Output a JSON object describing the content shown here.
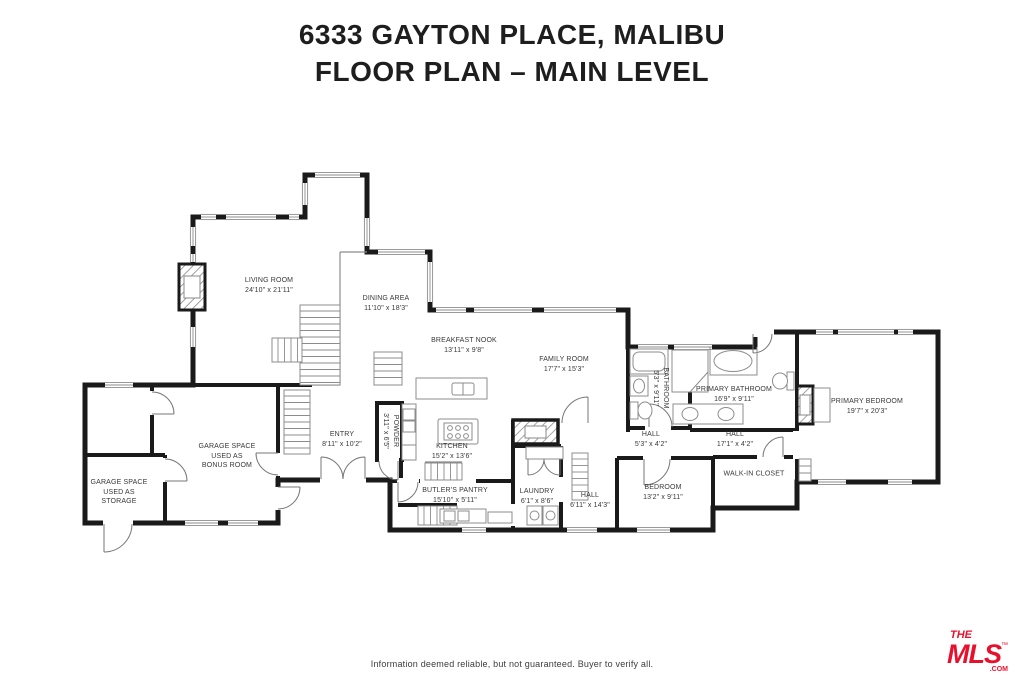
{
  "title": {
    "line1": "6333 GAYTON PLACE, MALIBU",
    "line2": "FLOOR PLAN – MAIN LEVEL"
  },
  "rooms": {
    "living_room": {
      "name": "LIVING ROOM",
      "dims": "24'10\" x 21'11\""
    },
    "dining_area": {
      "name": "DINING AREA",
      "dims": "11'10\" x 18'3\""
    },
    "breakfast_nook": {
      "name": "BREAKFAST NOOK",
      "dims": "13'11\" x 9'8\""
    },
    "family_room": {
      "name": "FAMILY ROOM",
      "dims": "17'7\" x 15'3\""
    },
    "kitchen": {
      "name": "KITCHEN",
      "dims": "15'2\" x 13'6\""
    },
    "entry": {
      "name": "ENTRY",
      "dims": "8'11\" x 10'2\""
    },
    "powder": {
      "name": "POWDER",
      "dims": "3'11\" x 6'5\""
    },
    "butlers_pantry": {
      "name": "BUTLER'S PANTRY",
      "dims": "15'10\" x 5'11\""
    },
    "laundry": {
      "name": "LAUNDRY",
      "dims": "6'1\" x 8'6\""
    },
    "hall": {
      "name": "HALL",
      "dims": "6'11\" x 14'3\""
    },
    "bedroom": {
      "name": "BEDROOM",
      "dims": "13'2\" x 9'11\""
    },
    "bathroom": {
      "name": "BATHROOM",
      "dims": "5'3\" x 9'11\""
    },
    "hall_small": {
      "name": "HALL",
      "dims": "5'3\" x 4'2\""
    },
    "primary_bathroom": {
      "name": "PRIMARY BATHROOM",
      "dims": "16'9\" x 9'11\""
    },
    "hall_primary": {
      "name": "HALL",
      "dims": "17'1\" x 4'2\""
    },
    "walk_in_closet": {
      "name": "WALK-IN CLOSET",
      "dims": ""
    },
    "primary_bedroom": {
      "name": "PRIMARY BEDROOM",
      "dims": "19'7\" x 20'3\""
    },
    "garage_bonus": {
      "name": "GARAGE SPACE\nUSED AS\nBONUS ROOM",
      "dims": ""
    },
    "garage_storage": {
      "name": "GARAGE SPACE\nUSED AS\nSTORAGE",
      "dims": ""
    }
  },
  "footer": {
    "disclaimer": "Information deemed reliable, but not guaranteed. Buyer to verify all."
  },
  "logo": {
    "the": "THE",
    "mls": "MLS",
    "tm": "™",
    "com": ".COM",
    "color": "#e8112d"
  }
}
